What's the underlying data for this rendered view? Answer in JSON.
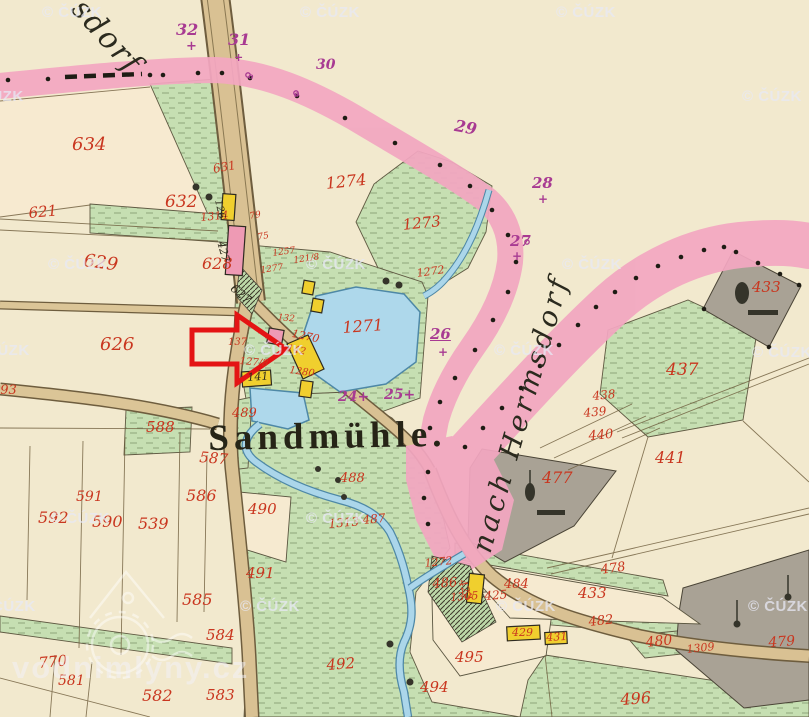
{
  "map": {
    "place_name": "Sandmühle.",
    "watermark": {
      "text": "© ČÚZK",
      "partial_text": "ČÚZK",
      "site": "vodnimlyny.cz"
    },
    "colors": {
      "paper": "#f2e9ce",
      "road_pink": "#f3a7c1",
      "road_tan": "#d9c193",
      "meadow_green": "#c6dfb2",
      "wood_gray": "#a9a295",
      "water_blue": "#aed8eb",
      "parcel_red": "#c9361f",
      "boundary_purple": "#a83a92",
      "building_yellow": "#f0cf2e",
      "building_pink": "#ee9ab4",
      "arrow_red": "#e41414"
    },
    "labels": {
      "red": [
        {
          "t": "634",
          "x": 72,
          "y": 136,
          "s": 18
        },
        {
          "t": "632",
          "x": 165,
          "y": 194,
          "s": 17
        },
        {
          "t": "631",
          "x": 212,
          "y": 163,
          "s": 12,
          "r": -10
        },
        {
          "t": "621",
          "x": 28,
          "y": 206,
          "s": 15,
          "r": -5
        },
        {
          "t": "629",
          "x": 85,
          "y": 252,
          "s": 18,
          "r": 8
        },
        {
          "t": "628",
          "x": 202,
          "y": 256,
          "s": 16
        },
        {
          "t": "626",
          "x": 100,
          "y": 336,
          "s": 18
        },
        {
          "t": "593",
          "x": -8,
          "y": 384,
          "s": 13
        },
        {
          "t": "1274",
          "x": 325,
          "y": 176,
          "s": 16,
          "r": -6
        },
        {
          "t": "1273",
          "x": 402,
          "y": 218,
          "s": 15,
          "r": -6
        },
        {
          "t": "1272",
          "x": 416,
          "y": 268,
          "s": 11,
          "r": -8
        },
        {
          "t": "1271",
          "x": 342,
          "y": 320,
          "s": 16,
          "r": -4
        },
        {
          "t": "1270",
          "x": 293,
          "y": 328,
          "s": 11,
          "r": 12
        },
        {
          "t": "142",
          "x": 288,
          "y": 344,
          "s": 10,
          "r": 12
        },
        {
          "t": "127/8",
          "x": 240,
          "y": 357,
          "s": 10,
          "r": 5
        },
        {
          "t": "1280",
          "x": 290,
          "y": 366,
          "s": 10,
          "r": 8
        },
        {
          "t": "137",
          "x": 228,
          "y": 338,
          "s": 10
        },
        {
          "t": "1257",
          "x": 272,
          "y": 250,
          "s": 9,
          "r": -8
        },
        {
          "t": "121/8",
          "x": 293,
          "y": 257,
          "s": 9,
          "r": -8
        },
        {
          "t": "1277",
          "x": 260,
          "y": 267,
          "s": 9,
          "r": -8
        },
        {
          "t": "132",
          "x": 278,
          "y": 314,
          "s": 9,
          "r": 5
        },
        {
          "t": "1314",
          "x": 200,
          "y": 212,
          "s": 11,
          "r": -5
        },
        {
          "t": "79",
          "x": 249,
          "y": 213,
          "s": 9,
          "r": -10
        },
        {
          "t": "75",
          "x": 257,
          "y": 234,
          "s": 9,
          "r": -10
        },
        {
          "t": "489",
          "x": 232,
          "y": 407,
          "s": 13
        },
        {
          "t": "588",
          "x": 146,
          "y": 420,
          "s": 15
        },
        {
          "t": "587",
          "x": 200,
          "y": 450,
          "s": 15,
          "r": 5
        },
        {
          "t": "586",
          "x": 186,
          "y": 488,
          "s": 16
        },
        {
          "t": "591",
          "x": 76,
          "y": 490,
          "s": 14
        },
        {
          "t": "592",
          "x": 38,
          "y": 510,
          "s": 16
        },
        {
          "t": "590",
          "x": 92,
          "y": 514,
          "s": 16
        },
        {
          "t": "539",
          "x": 138,
          "y": 516,
          "s": 16
        },
        {
          "t": "585",
          "x": 182,
          "y": 592,
          "s": 16
        },
        {
          "t": "584",
          "x": 206,
          "y": 628,
          "s": 15
        },
        {
          "t": "770",
          "x": 38,
          "y": 656,
          "s": 15,
          "r": -5
        },
        {
          "t": "581",
          "x": 58,
          "y": 674,
          "s": 14
        },
        {
          "t": "582",
          "x": 142,
          "y": 688,
          "s": 16
        },
        {
          "t": "583",
          "x": 206,
          "y": 688,
          "s": 15
        },
        {
          "t": "490",
          "x": 248,
          "y": 502,
          "s": 15
        },
        {
          "t": "491",
          "x": 246,
          "y": 566,
          "s": 15
        },
        {
          "t": "492",
          "x": 326,
          "y": 658,
          "s": 15,
          "r": -4
        },
        {
          "t": "494",
          "x": 420,
          "y": 680,
          "s": 15
        },
        {
          "t": "495",
          "x": 455,
          "y": 650,
          "s": 15
        },
        {
          "t": "496",
          "x": 620,
          "y": 692,
          "s": 16,
          "r": -4
        },
        {
          "t": "488",
          "x": 340,
          "y": 472,
          "s": 13
        },
        {
          "t": "1313",
          "x": 328,
          "y": 518,
          "s": 12,
          "r": -5
        },
        {
          "t": "487",
          "x": 362,
          "y": 514,
          "s": 12,
          "r": -5
        },
        {
          "t": "437",
          "x": 666,
          "y": 362,
          "s": 17
        },
        {
          "t": "438",
          "x": 592,
          "y": 390,
          "s": 12,
          "r": -5
        },
        {
          "t": "439",
          "x": 583,
          "y": 407,
          "s": 12,
          "r": -5
        },
        {
          "t": "440",
          "x": 588,
          "y": 430,
          "s": 13,
          "r": -5
        },
        {
          "t": "441",
          "x": 655,
          "y": 450,
          "s": 16
        },
        {
          "t": "433",
          "x": 752,
          "y": 280,
          "s": 15
        },
        {
          "t": "477",
          "x": 542,
          "y": 470,
          "s": 16
        },
        {
          "t": "478",
          "x": 600,
          "y": 564,
          "s": 13,
          "r": -8
        },
        {
          "t": "433",
          "x": 578,
          "y": 586,
          "s": 15
        },
        {
          "t": "482",
          "x": 588,
          "y": 616,
          "s": 13,
          "r": -6
        },
        {
          "t": "480",
          "x": 645,
          "y": 636,
          "s": 14,
          "r": -6
        },
        {
          "t": "479",
          "x": 768,
          "y": 636,
          "s": 14,
          "r": -4
        },
        {
          "t": "486",
          "x": 432,
          "y": 578,
          "s": 13,
          "r": -4
        },
        {
          "t": "1272",
          "x": 424,
          "y": 558,
          "s": 11,
          "r": -6
        },
        {
          "t": "484",
          "x": 504,
          "y": 578,
          "s": 13
        },
        {
          "t": "425",
          "x": 484,
          "y": 590,
          "s": 12,
          "r": -4
        },
        {
          "t": "1305",
          "x": 450,
          "y": 592,
          "s": 11,
          "r": -4
        },
        {
          "t": "1309",
          "x": 686,
          "y": 644,
          "s": 11,
          "r": -6
        },
        {
          "t": "423",
          "x": 467,
          "y": 578,
          "s": 11,
          "r": 70
        },
        {
          "t": "429",
          "x": 512,
          "y": 627,
          "s": 11
        },
        {
          "t": "431",
          "x": 546,
          "y": 632,
          "s": 11,
          "r": -3
        }
      ],
      "black": [
        {
          "t": "141",
          "x": 247,
          "y": 372,
          "s": 11,
          "r": -4
        },
        {
          "t": "427",
          "x": 226,
          "y": 240,
          "s": 11,
          "r": 75
        },
        {
          "t": "126",
          "x": 222,
          "y": 199,
          "s": 10,
          "r": 78
        },
        {
          "t": "627",
          "x": 236,
          "y": 282,
          "s": 12,
          "r": 40
        }
      ],
      "purple": [
        {
          "t": "32",
          "x": 176,
          "y": 22,
          "s": 16
        },
        {
          "t": "+",
          "x": 186,
          "y": 40,
          "s": 13
        },
        {
          "t": "31",
          "x": 228,
          "y": 32,
          "s": 16
        },
        {
          "t": "+",
          "x": 234,
          "y": 52,
          "s": 11
        },
        {
          "t": "30",
          "x": 316,
          "y": 58,
          "s": 14
        },
        {
          "t": "29",
          "x": 456,
          "y": 118,
          "s": 16,
          "r": 10
        },
        {
          "t": "28",
          "x": 532,
          "y": 176,
          "s": 15
        },
        {
          "t": "+",
          "x": 538,
          "y": 193,
          "s": 12
        },
        {
          "t": "27",
          "x": 510,
          "y": 234,
          "s": 15
        },
        {
          "t": "+",
          "x": 512,
          "y": 250,
          "s": 12
        },
        {
          "t": "26",
          "x": 430,
          "y": 327,
          "s": 15,
          "u": true
        },
        {
          "t": "+",
          "x": 438,
          "y": 346,
          "s": 12
        },
        {
          "t": "25+",
          "x": 384,
          "y": 388,
          "s": 14
        },
        {
          "t": "24+",
          "x": 338,
          "y": 390,
          "s": 14
        },
        {
          "t": "o",
          "x": 294,
          "y": 90,
          "s": 8
        },
        {
          "t": "o",
          "x": 248,
          "y": 72,
          "s": 8
        }
      ],
      "script": [
        {
          "t": "sdorf",
          "x": 88,
          "y": -6,
          "s": 30,
          "r": 48,
          "ls": 2
        },
        {
          "t": "nach Hermsdorf",
          "x": 468,
          "y": 548,
          "s": 28,
          "r": -74,
          "ls": 4
        }
      ],
      "place": [
        {
          "t": "Sandmühle.",
          "x": 208,
          "y": 420,
          "s": 37,
          "ls": 5,
          "r": -1
        }
      ]
    },
    "watermarks": [
      {
        "x": 42,
        "y": 4
      },
      {
        "x": 300,
        "y": 4
      },
      {
        "x": 556,
        "y": 4
      },
      {
        "x": -20,
        "y": 88,
        "t": "ČÚZK"
      },
      {
        "x": 742,
        "y": 88
      },
      {
        "x": 48,
        "y": 256
      },
      {
        "x": 306,
        "y": 256
      },
      {
        "x": 562,
        "y": 256
      },
      {
        "x": -14,
        "y": 342,
        "t": "ČÚZK"
      },
      {
        "x": 244,
        "y": 342
      },
      {
        "x": 494,
        "y": 342
      },
      {
        "x": 752,
        "y": 344
      },
      {
        "x": 50,
        "y": 510
      },
      {
        "x": 306,
        "y": 510
      },
      {
        "x": -8,
        "y": 598,
        "t": "ČÚZK"
      },
      {
        "x": 240,
        "y": 598
      },
      {
        "x": 496,
        "y": 598
      },
      {
        "x": 748,
        "y": 598
      }
    ]
  }
}
